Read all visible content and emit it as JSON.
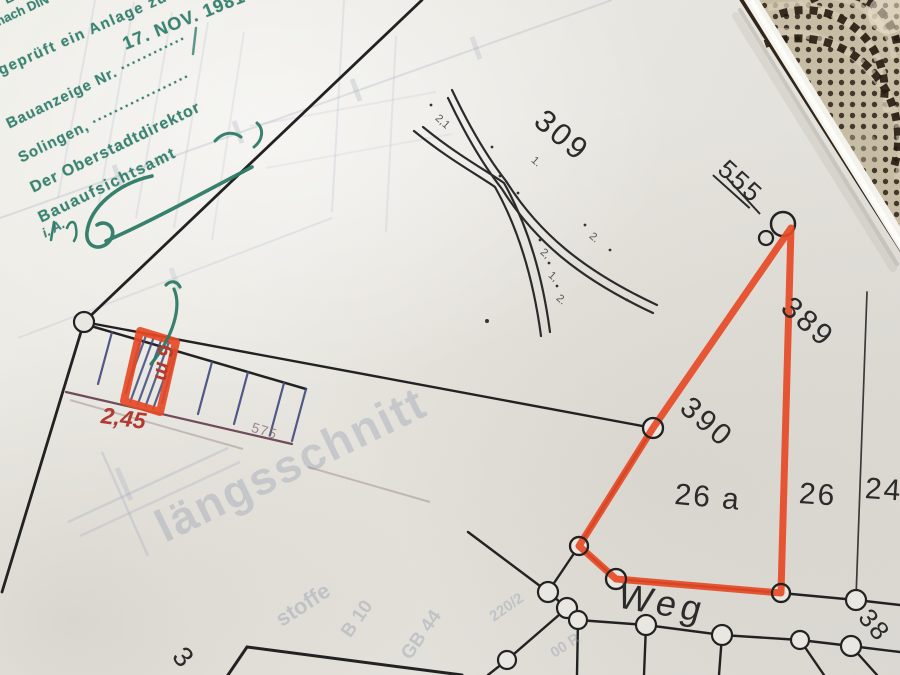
{
  "stamp": {
    "fragment_top": "Em",
    "fragment_din": "nach DIN",
    "approval_line": "geprüft ein Anlage zu",
    "bauanzeige_line": "Bauanzeige Nr. ············",
    "date_stamp": "17. NOV. 1981",
    "city_line": "Solingen, ··················",
    "director_line": "Der Oberstadtdirektor",
    "office_line": "Bauaufsichtsamt",
    "signature_prefix": "i. A.",
    "ink_color": "#2c7a68"
  },
  "parcel_labels": {
    "p309": "309",
    "p555_struck": "555",
    "p389": "389",
    "p390": "390",
    "p26a": "26 a",
    "p26": "26",
    "p24": "24",
    "p38_clipped": "38",
    "p3_clipped": "3",
    "weg": "Weg"
  },
  "path_width_marks": {
    "m1": "2,1",
    "m2": "1.",
    "m3": "2.",
    "m4": "2,",
    "m5": "1,",
    "m6": "2."
  },
  "red_annotations": {
    "stall_width": "2,45",
    "stall_depth": "6 m",
    "ink_color": "#b23a2e"
  },
  "dimension_575": "575",
  "bleed_through": {
    "laengsschnitt": "längsschnitt",
    "stoffe": "stoffe",
    "b10": "B 10",
    "gb44": "GB 44",
    "r220": "220/2",
    "r00": "00 R"
  },
  "highlight_color": "#e64a26",
  "hatch_color": "#3f4a7e"
}
